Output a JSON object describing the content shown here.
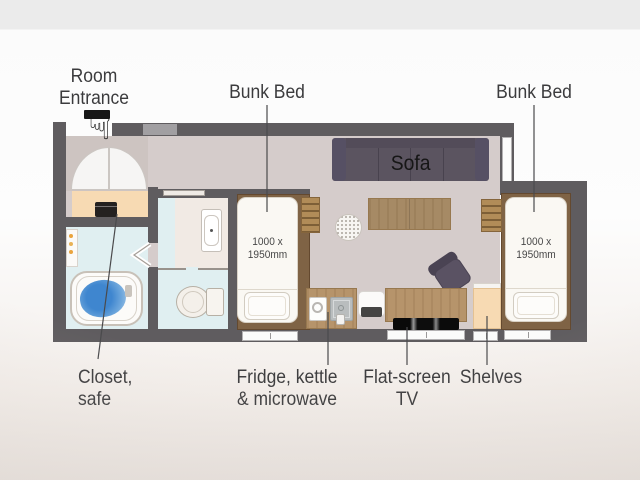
{
  "scene": {
    "description": "Hotel room floor plan with annotated furniture"
  },
  "labels": {
    "room_entrance_line1": "Room",
    "room_entrance_line2": "Entrance",
    "bunk_bed_left": "Bunk Bed",
    "bunk_bed_right": "Bunk Bed",
    "closet_line1": "Closet,",
    "closet_line2": "safe",
    "fridge_line1": "Fridge, kettle",
    "fridge_line2": "& microwave",
    "tv_line1": "Flat-screen",
    "tv_line2": "TV",
    "shelves": "Shelves"
  },
  "floorplan": {
    "sofa_label": "Sofa",
    "bed_dim_line1": "1000 x",
    "bed_dim_line2": "1950mm"
  },
  "icons": {
    "entrance_pointer_glyph": "☟"
  },
  "colors": {
    "wall": "#5f5c5f",
    "floor_main": "#d5cccb",
    "floor_entrance": "#cdc4c1",
    "floor_bathroom": "#e0eff1",
    "closet_shelves_peach": "#f7dab3",
    "sofa": "#5b5460",
    "wood_light": "#b6946b",
    "wood_dark": "#7f6345",
    "bath_water": "#4287cd",
    "label_text": "#3b3b3d",
    "top_band": "#ebebeb"
  }
}
